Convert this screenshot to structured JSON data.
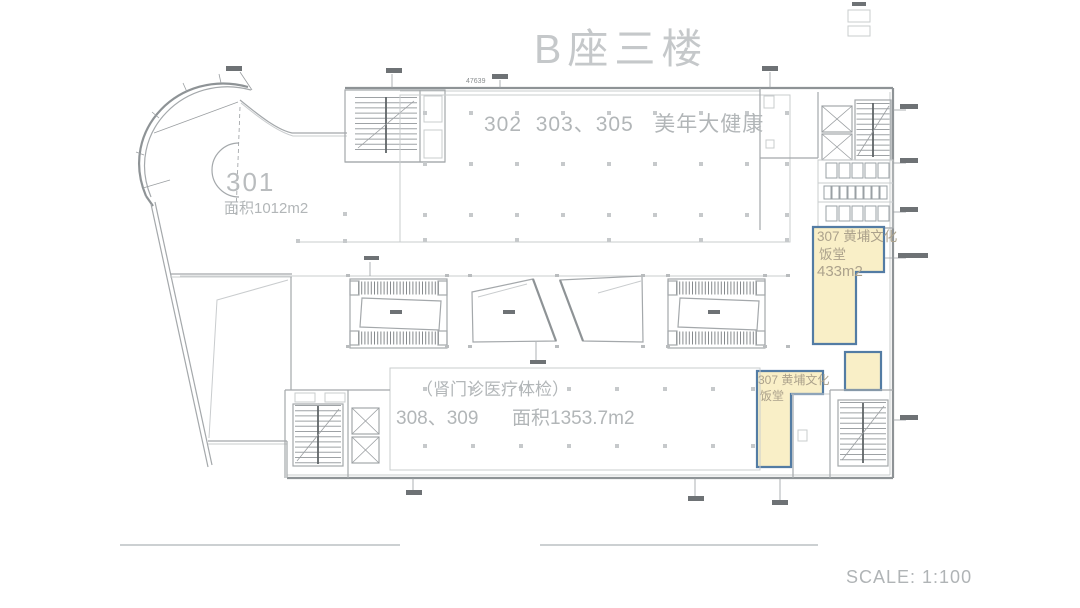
{
  "title": "B座三楼",
  "scale_label": "SCALE: 1:100",
  "top_dimension": "47639",
  "rooms": {
    "r301": {
      "number": "301",
      "area": "面积1012m2"
    },
    "r302": {
      "label": "302  303、305   美年大健康"
    },
    "r307_upper": {
      "line1": "307 黄埔文化",
      "line2": "饭堂",
      "line3": "433m2"
    },
    "r307_lower": {
      "line1": "307 黄埔文化",
      "line2": "饭堂"
    },
    "r308_309": {
      "note": "（肾门诊医疗体检）",
      "numbers": "308、309",
      "area": "面积1353.7m2"
    }
  },
  "colors": {
    "highlight_fill": "#F9EFC7",
    "highlight_border": "#537CA4",
    "wall": "#8E9396",
    "text": "#B2B6B8"
  }
}
